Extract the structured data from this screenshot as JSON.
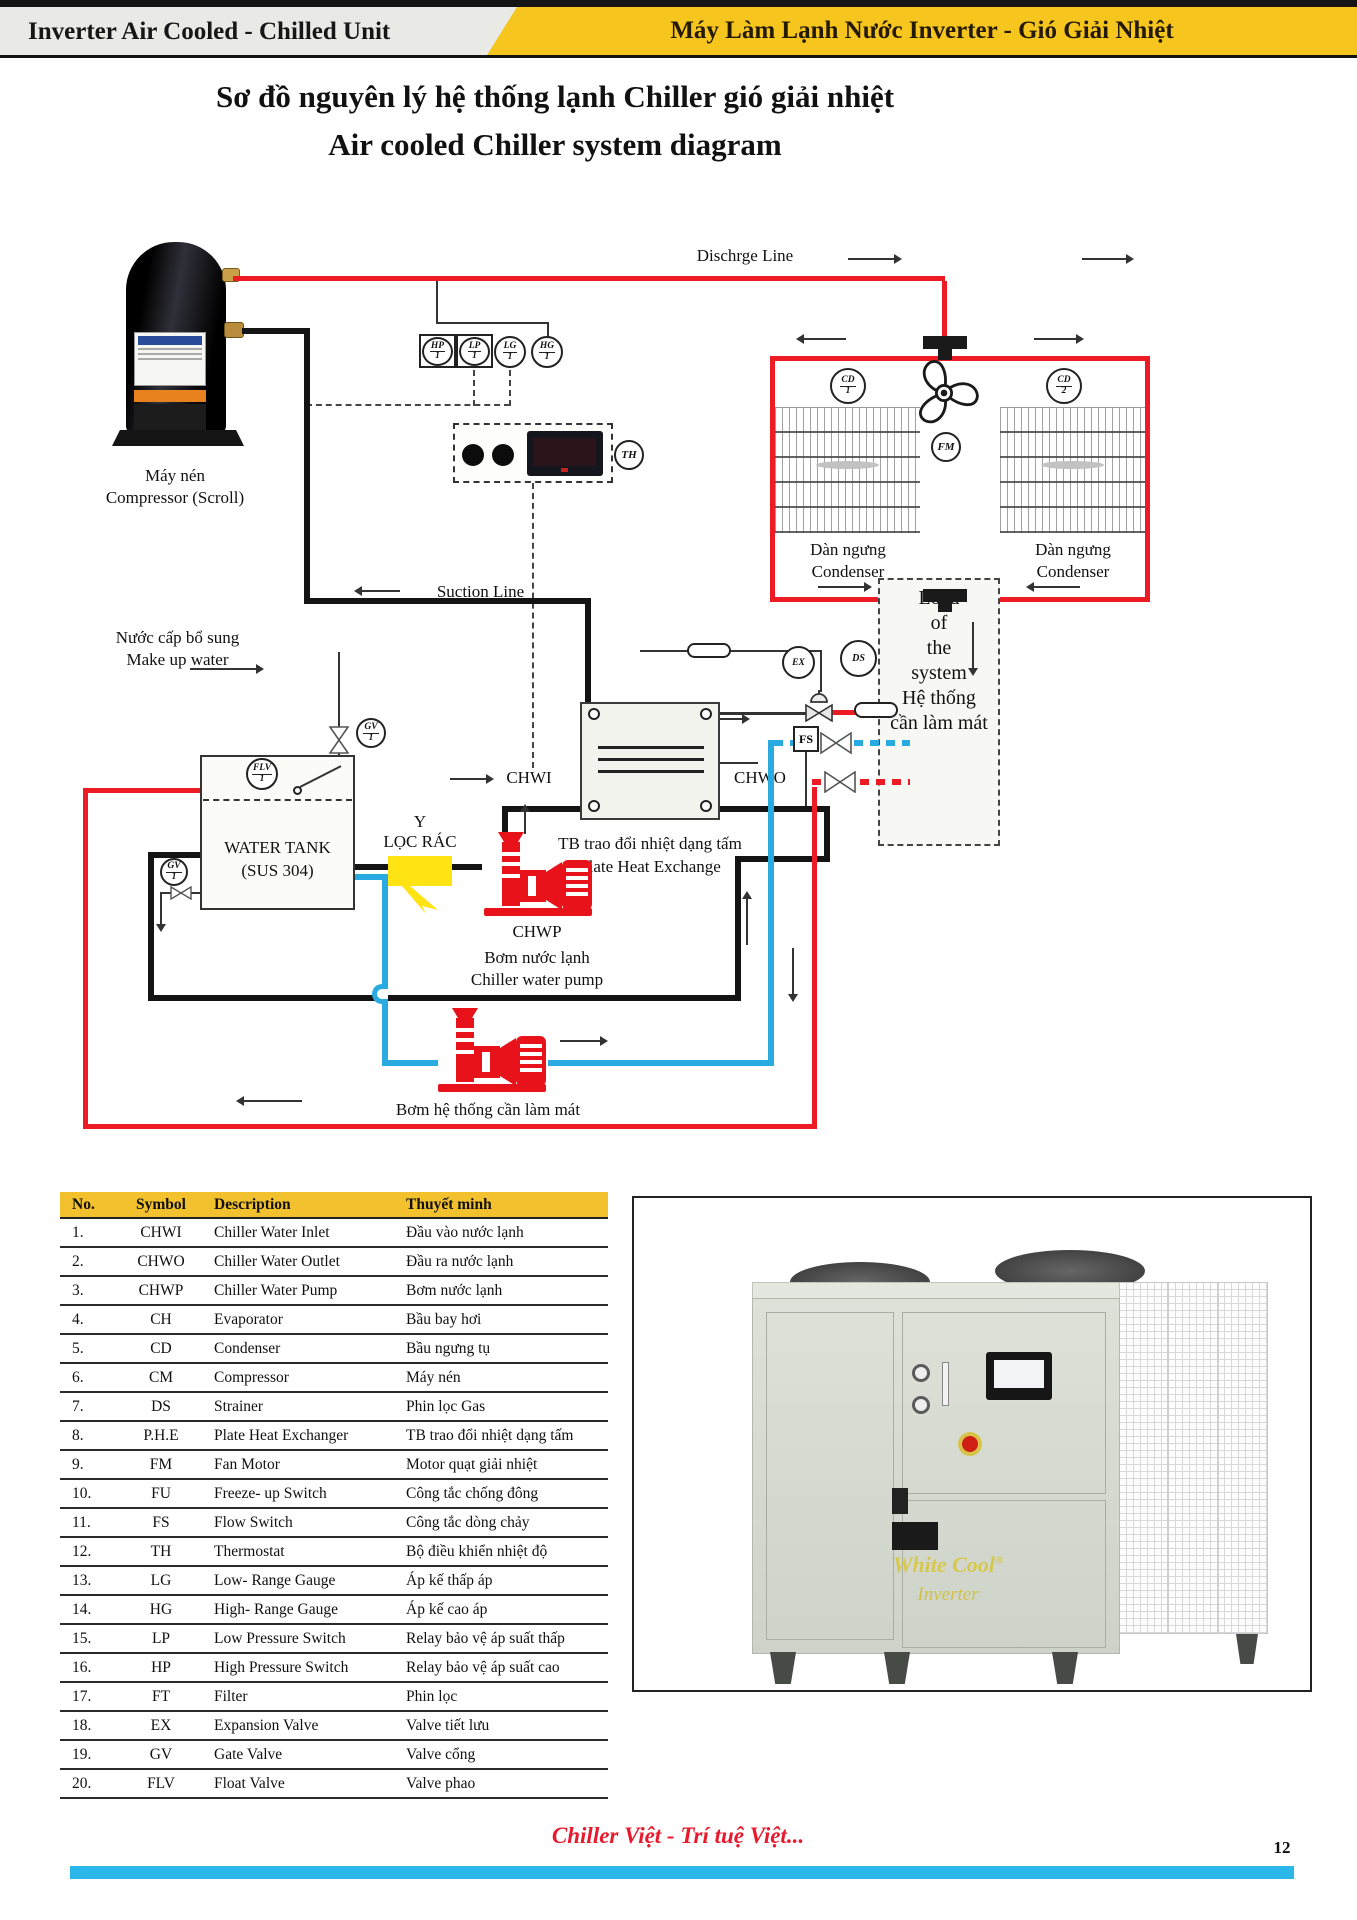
{
  "header": {
    "left_title": "Inverter Air Cooled - Chilled Unit",
    "right_title": "Máy Làm Lạnh Nước Inverter - Gió Giải Nhiệt"
  },
  "title": {
    "line1": "Sơ đồ nguyên lý hệ thống lạnh Chiller gió giải nhiệt",
    "line2": "Air cooled Chiller system diagram"
  },
  "diagram": {
    "discharge_line": "Dischrge Line",
    "suction_line": "Suction Line",
    "makeup_line1": "Nước cấp bổ sung",
    "makeup_line2": "Make up water",
    "compressor_line1": "Máy nén",
    "compressor_line2": "Compressor (Scroll)",
    "condenser1_line1": "Dàn ngưng",
    "condenser1_line2": "Condenser",
    "condenser2_line1": "Dàn ngưng",
    "condenser2_line2": "Condenser",
    "water_tank_line1": "WATER TANK",
    "water_tank_line2": "(SUS 304)",
    "strainer_line1": "Y",
    "strainer_line2": "LỌC RÁC",
    "chwi": "CHWI",
    "chwo": "CHWO",
    "fs": "FS",
    "phe_line1": "TB trao đổi nhiệt dạng tấm",
    "phe_line2": "Plate Heat Exchange",
    "chwp": "CHWP",
    "chwp_line1": "Bơm nước lạnh",
    "chwp_line2": "Chiller water pump",
    "system_pump": "Bơm hệ thống cần làm mát",
    "load_lines": [
      "Load",
      "of",
      "the",
      "system",
      "Hệ thống",
      "cần làm mát"
    ]
  },
  "instruments": {
    "hp": {
      "tag": "HP",
      "num": "1"
    },
    "lp": {
      "tag": "LP",
      "num": "1"
    },
    "lg": {
      "tag": "LG",
      "num": "1"
    },
    "hg": {
      "tag": "HG",
      "num": "1"
    },
    "cd1": {
      "tag": "CD",
      "num": "1"
    },
    "cd2": {
      "tag": "CD",
      "num": "2"
    },
    "gv_fill": {
      "tag": "GV",
      "num": "1"
    },
    "gv_drain": {
      "tag": "GV",
      "num": "1"
    },
    "flv": {
      "tag": "FLV",
      "num": "1"
    },
    "fm": "FM",
    "th": "TH",
    "ex": "EX",
    "ds": "DS"
  },
  "table": {
    "headers": [
      "No.",
      "Symbol",
      "Description",
      "Thuyết minh"
    ],
    "rows": [
      {
        "no": "1.",
        "symbol": "CHWI",
        "description": "Chiller Water Inlet",
        "thuyet_minh": "Đầu vào nước lạnh"
      },
      {
        "no": "2.",
        "symbol": "CHWO",
        "description": "Chiller Water Outlet",
        "thuyet_minh": "Đầu ra nước lạnh"
      },
      {
        "no": "3.",
        "symbol": "CHWP",
        "description": "Chiller Water Pump",
        "thuyet_minh": "Bơm nước lạnh"
      },
      {
        "no": "4.",
        "symbol": "CH",
        "description": "Evaporator",
        "thuyet_minh": "Bầu bay hơi"
      },
      {
        "no": "5.",
        "symbol": "CD",
        "description": "Condenser",
        "thuyet_minh": "Bầu ngưng tụ"
      },
      {
        "no": "6.",
        "symbol": "CM",
        "description": "Compressor",
        "thuyet_minh": "Máy nén"
      },
      {
        "no": "7.",
        "symbol": "DS",
        "description": "Strainer",
        "thuyet_minh": "Phin lọc Gas"
      },
      {
        "no": "8.",
        "symbol": "P.H.E",
        "description": "Plate Heat Exchanger",
        "thuyet_minh": "TB trao đổi nhiệt dạng tấm"
      },
      {
        "no": "9.",
        "symbol": "FM",
        "description": "Fan Motor",
        "thuyet_minh": "Motor quạt giải nhiệt"
      },
      {
        "no": "10.",
        "symbol": "FU",
        "description": "Freeze- up Switch",
        "thuyet_minh": "Công tắc chống đông"
      },
      {
        "no": "11.",
        "symbol": "FS",
        "description": "Flow Switch",
        "thuyet_minh": "Công tắc dòng chảy"
      },
      {
        "no": "12.",
        "symbol": "TH",
        "description": "Thermostat",
        "thuyet_minh": "Bộ điều khiển nhiệt độ"
      },
      {
        "no": "13.",
        "symbol": "LG",
        "description": "Low- Range Gauge",
        "thuyet_minh": "Áp kế thấp áp"
      },
      {
        "no": "14.",
        "symbol": "HG",
        "description": "High- Range Gauge",
        "thuyet_minh": "Áp kế cao áp"
      },
      {
        "no": "15.",
        "symbol": "LP",
        "description": "Low Pressure Switch",
        "thuyet_minh": "Relay bảo vệ áp suất thấp"
      },
      {
        "no": "16.",
        "symbol": "HP",
        "description": "High Pressure Switch",
        "thuyet_minh": "Relay bảo vệ áp suất cao"
      },
      {
        "no": "17.",
        "symbol": "FT",
        "description": "Filter",
        "thuyet_minh": "Phin lọc"
      },
      {
        "no": "18.",
        "symbol": "EX",
        "description": "Expansion Valve",
        "thuyet_minh": "Valve tiết lưu"
      },
      {
        "no": "19.",
        "symbol": "GV",
        "description": "Gate Valve",
        "thuyet_minh": "Valve cổng"
      },
      {
        "no": "20.",
        "symbol": "FLV",
        "description": "Float Valve",
        "thuyet_minh": "Valve phao"
      }
    ]
  },
  "unit_image": {
    "brand": "White Cool",
    "reg": "®",
    "sub": "Inverter"
  },
  "footer": {
    "slogan": "Chiller Việt - Trí tuệ Việt...",
    "page": "12"
  },
  "colors": {
    "accent_yellow": "#F6C51E",
    "pipe_red": "#ED1C24",
    "pipe_blue": "#29ABE2",
    "footer_bar": "#2BB7E9"
  }
}
